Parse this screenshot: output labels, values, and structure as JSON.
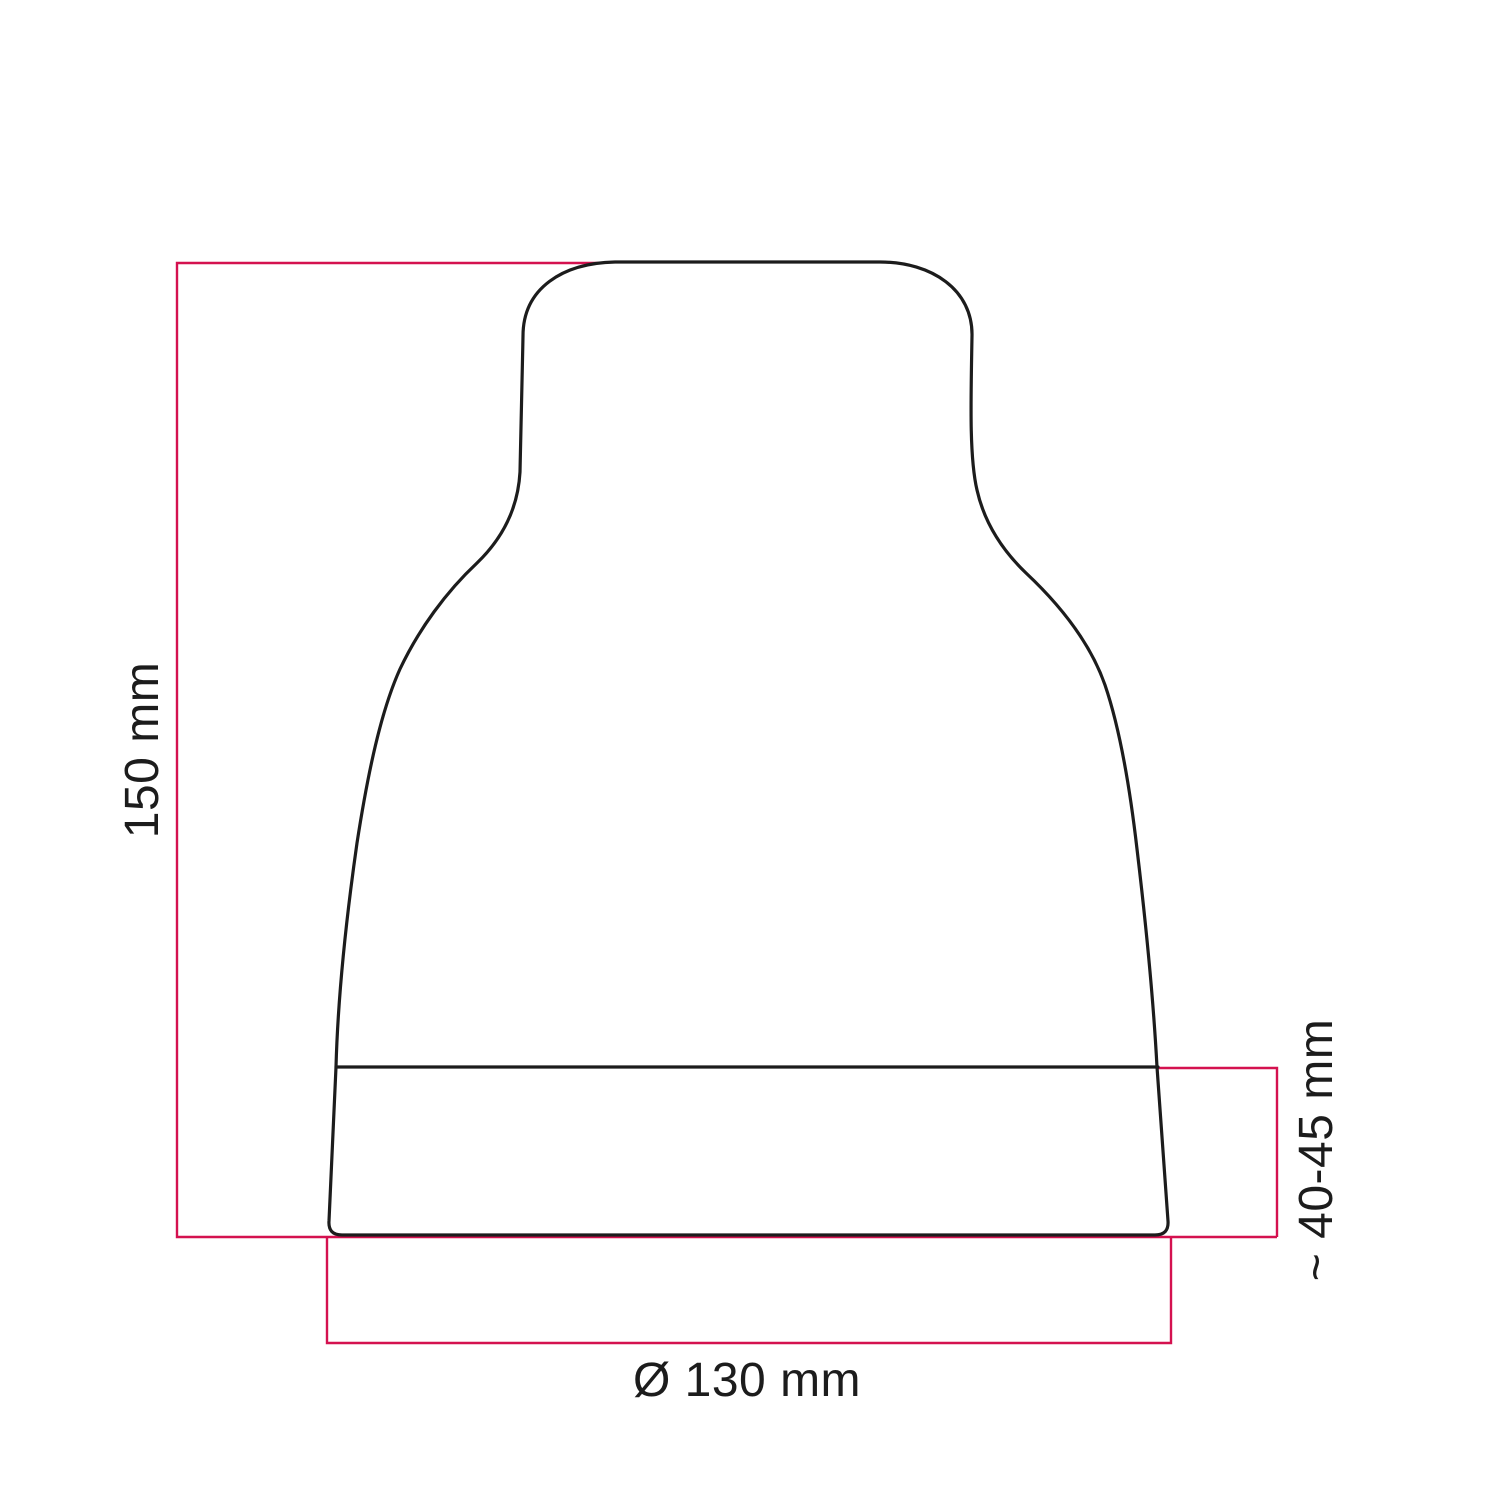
{
  "colors": {
    "outline": "#1c1c1c",
    "dimension": "#d4114f",
    "label": "#1c1c1c"
  },
  "dimensions": {
    "height": {
      "label": "150 mm"
    },
    "base_height": {
      "label": "~ 40-45 mm"
    },
    "diameter": {
      "label": "Ø 130 mm"
    }
  }
}
